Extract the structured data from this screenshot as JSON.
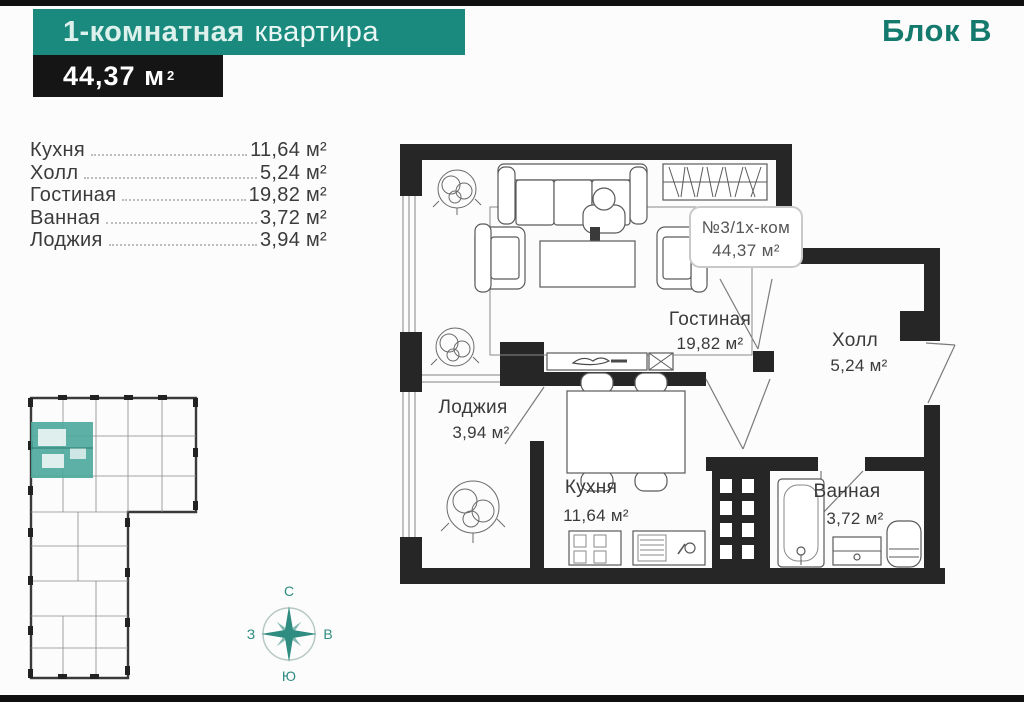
{
  "header": {
    "title_bold": "1-комнатная",
    "title_regular": "квартира",
    "area_value": "44,37 м",
    "area_sup": "2",
    "block_label": "Блок В"
  },
  "room_list": [
    {
      "label": "Кухня",
      "value": "11,64 м²"
    },
    {
      "label": "Холл",
      "value": "5,24 м²"
    },
    {
      "label": "Гостиная",
      "value": "19,82 м²"
    },
    {
      "label": "Ванная",
      "value": "3,72 м²"
    },
    {
      "label": "Лоджия",
      "value": "3,94 м²"
    }
  ],
  "floor_plan": {
    "unit_badge": {
      "line1": "№3/1х-ком",
      "line2": "44,37 м²"
    },
    "rooms": [
      {
        "name": "Гостиная",
        "area": "19,82 м²"
      },
      {
        "name": "Холл",
        "area": "5,24 м²"
      },
      {
        "name": "Лоджия",
        "area": "3,94 м²"
      },
      {
        "name": "Кухня",
        "area": "11,64 м²"
      },
      {
        "name": "Ванная",
        "area": "3,72 м²"
      }
    ]
  },
  "compass": {
    "north": "С",
    "east": "В",
    "south": "Ю",
    "west": "З"
  },
  "colors": {
    "banner_teal": "#1b8a7e",
    "block_teal": "#157a6e",
    "area_box_black": "#151515",
    "wall_black": "#262626",
    "thumb_highlight_teal": "#4aa79b",
    "compass_teal": "#2e8c80"
  }
}
